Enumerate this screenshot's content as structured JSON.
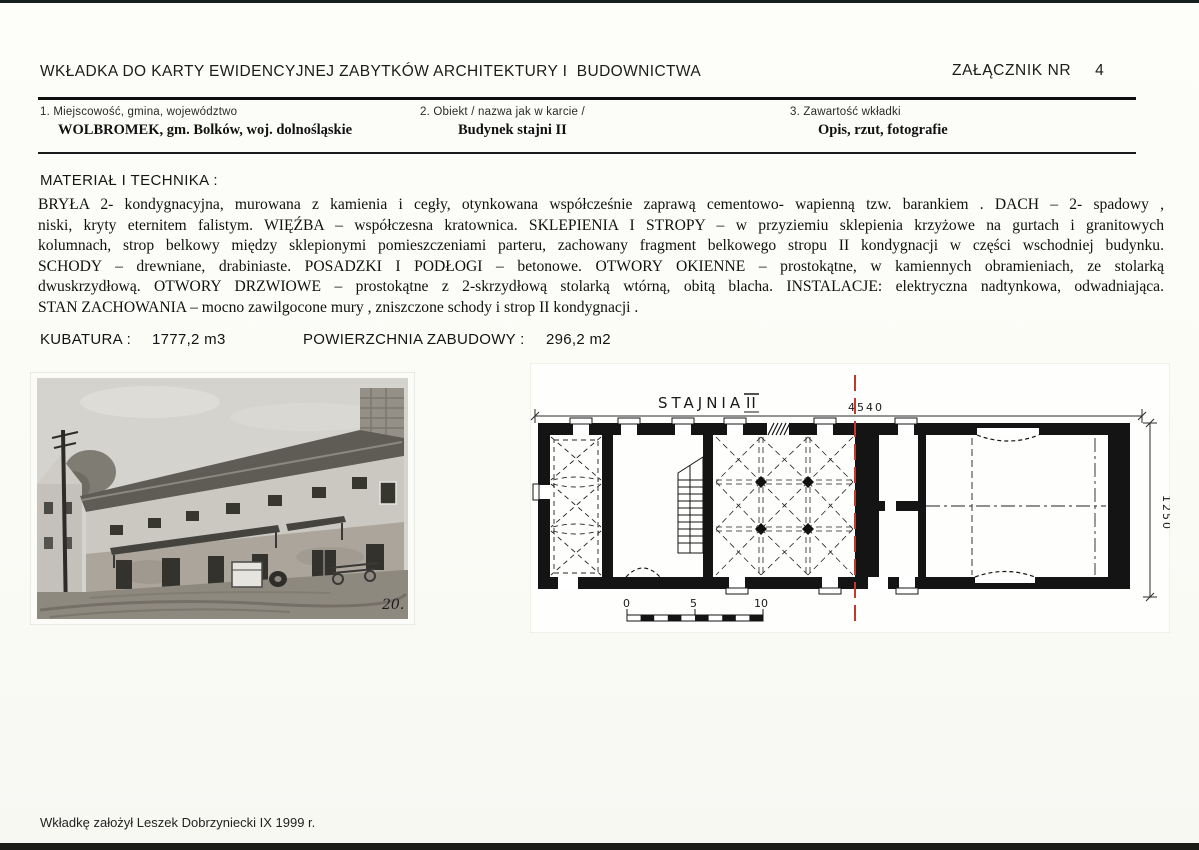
{
  "header": {
    "title": "WKŁADKA DO KARTY EWIDENCYJNEJ ZABYTKÓW ARCHITEKTURY I  BUDOWNICTWA",
    "attachment_label": "ZAŁĄCZNIK NR",
    "attachment_number": "4"
  },
  "fields": [
    {
      "label": "1. Miejscowość, gmina, województwo",
      "value": "WOLBROMEK, gm. Bolków, woj. dolnośląskie"
    },
    {
      "label": "2. Obiekt / nazwa jak w karcie /",
      "value": "Budynek stajni II"
    },
    {
      "label": "3. Zawartość wkładki",
      "value": "Opis, rzut, fotografie"
    }
  ],
  "material": {
    "heading": "MATERIAŁ I TECHNIKA :",
    "lines": [
      "BRYŁA  2- kondygnacyjna, murowana z kamienia  i cegły, otynkowana współcześnie zaprawą cementowo- wapienną tzw. barankiem . DACH – 2- spadowy ,",
      "niski, kryty eternitem falistym. WIĘŹBA – współczesna kratownica. SKLEPIENIA I STROPY – w przyziemiu sklepienia krzyżowe na gurtach i granitowych",
      "kolumnach, strop belkowy między sklepionymi pomieszczeniami parteru, zachowany fragment belkowego stropu II kondygnacji w części wschodniej budynku.",
      "SCHODY – drewniane, drabiniaste. POSADZKI I PODŁOGI – betonowe. OTWORY OKIENNE – prostokątne, w kamiennych obramieniach, ze stolarką",
      "dwuskrzydłową. OTWORY DRZWIOWE – prostokątne z 2-skrzydłową stolarką wtórną, obitą blacha. INSTALACJE: elektryczna nadtynkowa, odwadniająca.",
      "STAN ZACHOWANIA – mocno zawilgocone mury , zniszczone schody i strop II kondygnacji ."
    ]
  },
  "metrics": {
    "kubatura_label": "KUBATURA :",
    "kubatura_value": "1777,2 m3",
    "powierzchnia_label": "POWIERZCHNIA ZABUDOWY :",
    "powierzchnia_value": "296,2 m2"
  },
  "photo": {
    "number": "20."
  },
  "plan": {
    "title_main": "STAJNIA",
    "title_numeral": "II",
    "dim_length": "4540",
    "dim_width": "1250",
    "scale_labels": [
      "0",
      "5",
      "10"
    ]
  },
  "footer": {
    "note": "Wkładkę założył Leszek Dobrzyniecki IX 1999 r."
  },
  "colors": {
    "accent_red": "#c23a2b",
    "ink": "#141414"
  }
}
